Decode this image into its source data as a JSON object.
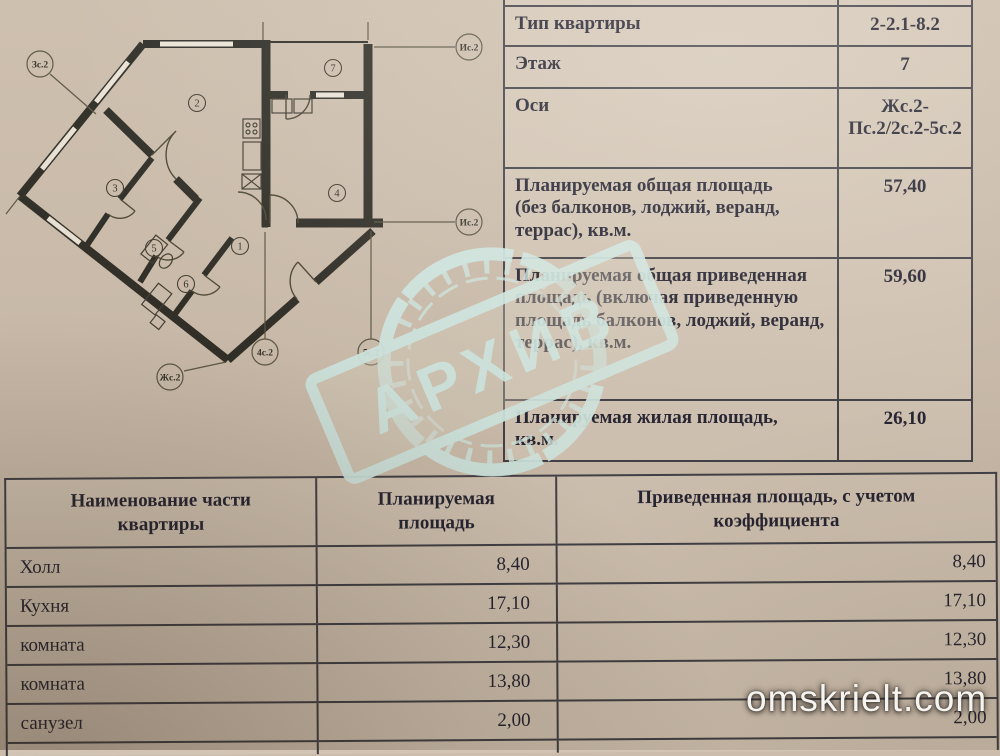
{
  "stamp": {
    "text": "АРХИВ"
  },
  "watermark": {
    "text": "omskrielt.com"
  },
  "floor_plan": {
    "axis_labels": {
      "top_left": "Зс.2",
      "right_top": "Ис.2",
      "right_bottom": "Ис.2",
      "bottom_left": "Жс.2",
      "bottom_center": "4с.2",
      "bottom_right": "5с.2"
    },
    "room_numbers": {
      "loggia": "7",
      "main_room": "2",
      "left_room": "3",
      "right_room": "4",
      "hall": "1",
      "bath_a": "5",
      "bath_b": "6"
    }
  },
  "info_table": {
    "rows": [
      {
        "label": "Тип квартиры",
        "value": "2-2.1-8.2"
      },
      {
        "label": "Этаж",
        "value": "7"
      },
      {
        "label": "Оси",
        "value": "Жс.2-Пс.2/2с.2-5с.2"
      },
      {
        "label": "Планируемая общая площадь (без балконов, лоджий, веранд, террас), кв.м.",
        "value": "57,40"
      },
      {
        "label": "Планируемая общая приведенная площадь (включая приведенную площадь балконов, лоджий, веранд, террас), кв.м.",
        "value": "59,60"
      },
      {
        "label": "Планируемая жилая площадь, кв.м.",
        "value": "26,10"
      }
    ]
  },
  "parts_table": {
    "headers": [
      "Наименование части квартиры",
      "Планируемая площадь",
      "Приведенная площадь, с учетом коэффициента"
    ],
    "rows": [
      {
        "name": "Холл",
        "planned": "8,40",
        "reduced": "8,40"
      },
      {
        "name": "Кухня",
        "planned": "17,10",
        "reduced": "17,10"
      },
      {
        "name": "комната",
        "planned": "12,30",
        "reduced": "12,30"
      },
      {
        "name": "комната",
        "planned": "13,80",
        "reduced": "13,80"
      },
      {
        "name": "санузел",
        "planned": "2,00",
        "reduced": "2,00"
      }
    ]
  },
  "colors": {
    "paper": "#cbbcab",
    "text_ink": "#1c1c2b",
    "table_line": "#3a3a41",
    "stamp_ink": "#cfe9e4"
  }
}
